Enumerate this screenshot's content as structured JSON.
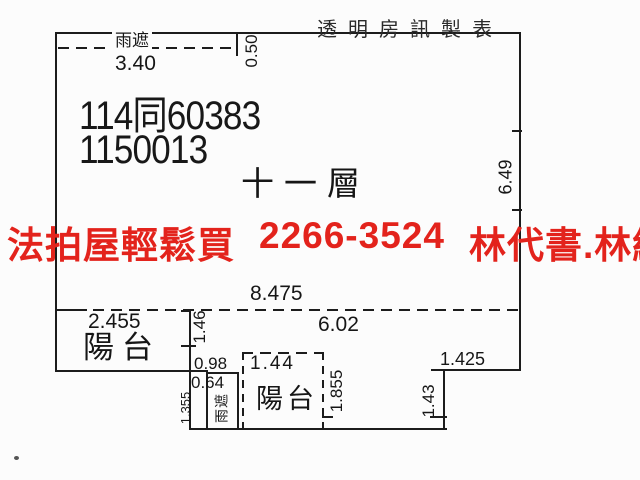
{
  "maker": {
    "label": "透明房訊製表"
  },
  "unit": {
    "case_no": "114同60383",
    "serial_no": "1150013",
    "floor": "十一層"
  },
  "ad": {
    "slogan": "法拍屋輕鬆買",
    "phone": "2266-3524",
    "contacts": "林代書.林經理"
  },
  "rooms": {
    "rain_shelter_top": "雨遮",
    "balcony_left": "陽台",
    "balcony_bottom": "陽台",
    "rain_shelter_bottom": "雨遮"
  },
  "dimensions": {
    "rain_top_width": "3.40",
    "rain_top_depth": "0.50",
    "right_wall_height": "6.49",
    "interior_span": "8.475",
    "balcony_left_width": "2.455",
    "interior_right_span": "6.02",
    "balcony_depth": "1.46",
    "gap_width": "0.98",
    "bottom_balcony_width": "1.44",
    "rain_bottom_width": "0.64",
    "rain_bottom_height": "1.355",
    "bottom_balcony_depth": "1.855",
    "step_width": "1.425",
    "step_height": "1.43"
  },
  "colors": {
    "ad_red": "#e3231c",
    "line_black": "#1c1c1c",
    "background": "#fcfcfc"
  }
}
